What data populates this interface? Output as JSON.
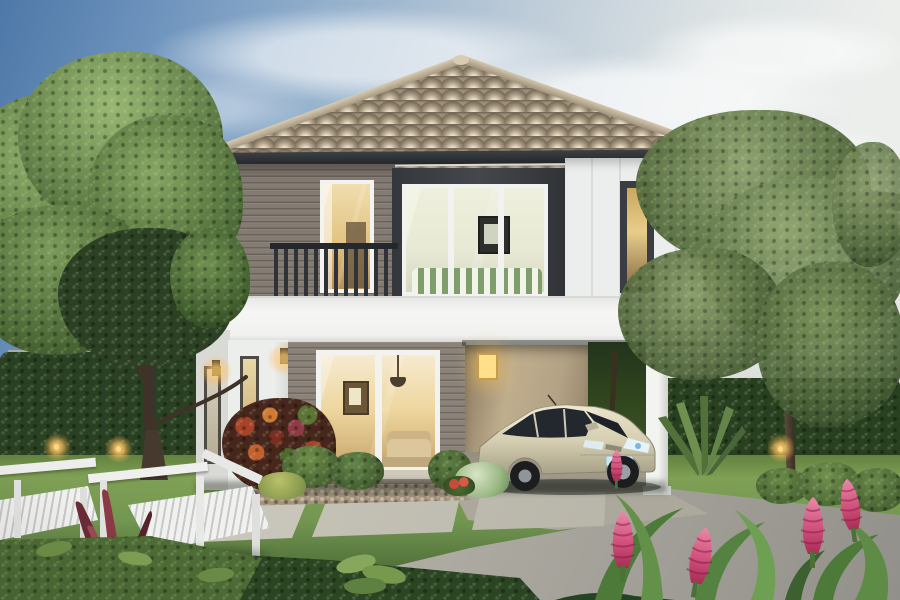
{
  "scene": {
    "description": "Dusk architectural rendering of a modern two-storey house with brown hip tile roof, dark-framed upper bay window and balcony, warm lit interiors, grey and white siding, carport sheltering a champagne minivan, landscaped garden with trees, clipped hedges, white slatted benches, stepping-stone lawn, driveway and pink ginger flowers in the foreground",
    "time_of_day": "dusk",
    "style": "architectural-rendering"
  },
  "colors": {
    "sky_top": "#4e78a8",
    "sky_horizon": "#eceeec",
    "roof_tile": "#9c8e78",
    "roof_ridge": "#cdbfa6",
    "fascia": "#313538",
    "wall_white": "#eef0ed",
    "siding_gray": "#8b8379",
    "accent_dark": "#3a3d41",
    "floor_band": "#f3f4f2",
    "carport_wall": "#b3a284",
    "window_warm": "#f0dcae",
    "window_glow": "#ffdf8a",
    "railing": "#2f3337",
    "lawn": "#739651",
    "hedge": "#2c4124",
    "tree_canopy": "#5d7a42",
    "driveway": "#bcb9b0",
    "paver": "#d2cfc4",
    "gravel": "#a2937f",
    "car_body": "#d6cfb2",
    "car_glass": "#23272e",
    "license_plate": "#cfe6f2",
    "bench_white": "#edeeec",
    "cordyline": "#6b2a38",
    "croton_orange": "#d07b35",
    "flower_pink": "#d1517c",
    "trunk": "#3e3229",
    "bg_house_roof": "#4e4a45",
    "fence": "#e3e5e2",
    "uplight": "#ffcf7a"
  },
  "objects": [
    "sky",
    "clouds",
    "left-tree",
    "right-tree",
    "palm-fronds",
    "background-house",
    "boundary-fence",
    "hedges",
    "main-house",
    "hip-roof",
    "balcony-railing",
    "bedroom-window",
    "bay-window",
    "narrow-window",
    "floor-band",
    "left-wing",
    "sliding-glass-door",
    "carport",
    "carport-glow-window",
    "carport-column",
    "minivan",
    "driveway",
    "stepping-pavers",
    "lawn",
    "gravel-bed",
    "garden-benches",
    "cordyline-plant",
    "croton-shrub",
    "garden-bushes",
    "garden-uplights",
    "wall-lamps",
    "ginger-flowers",
    "foreground-hedge"
  ]
}
